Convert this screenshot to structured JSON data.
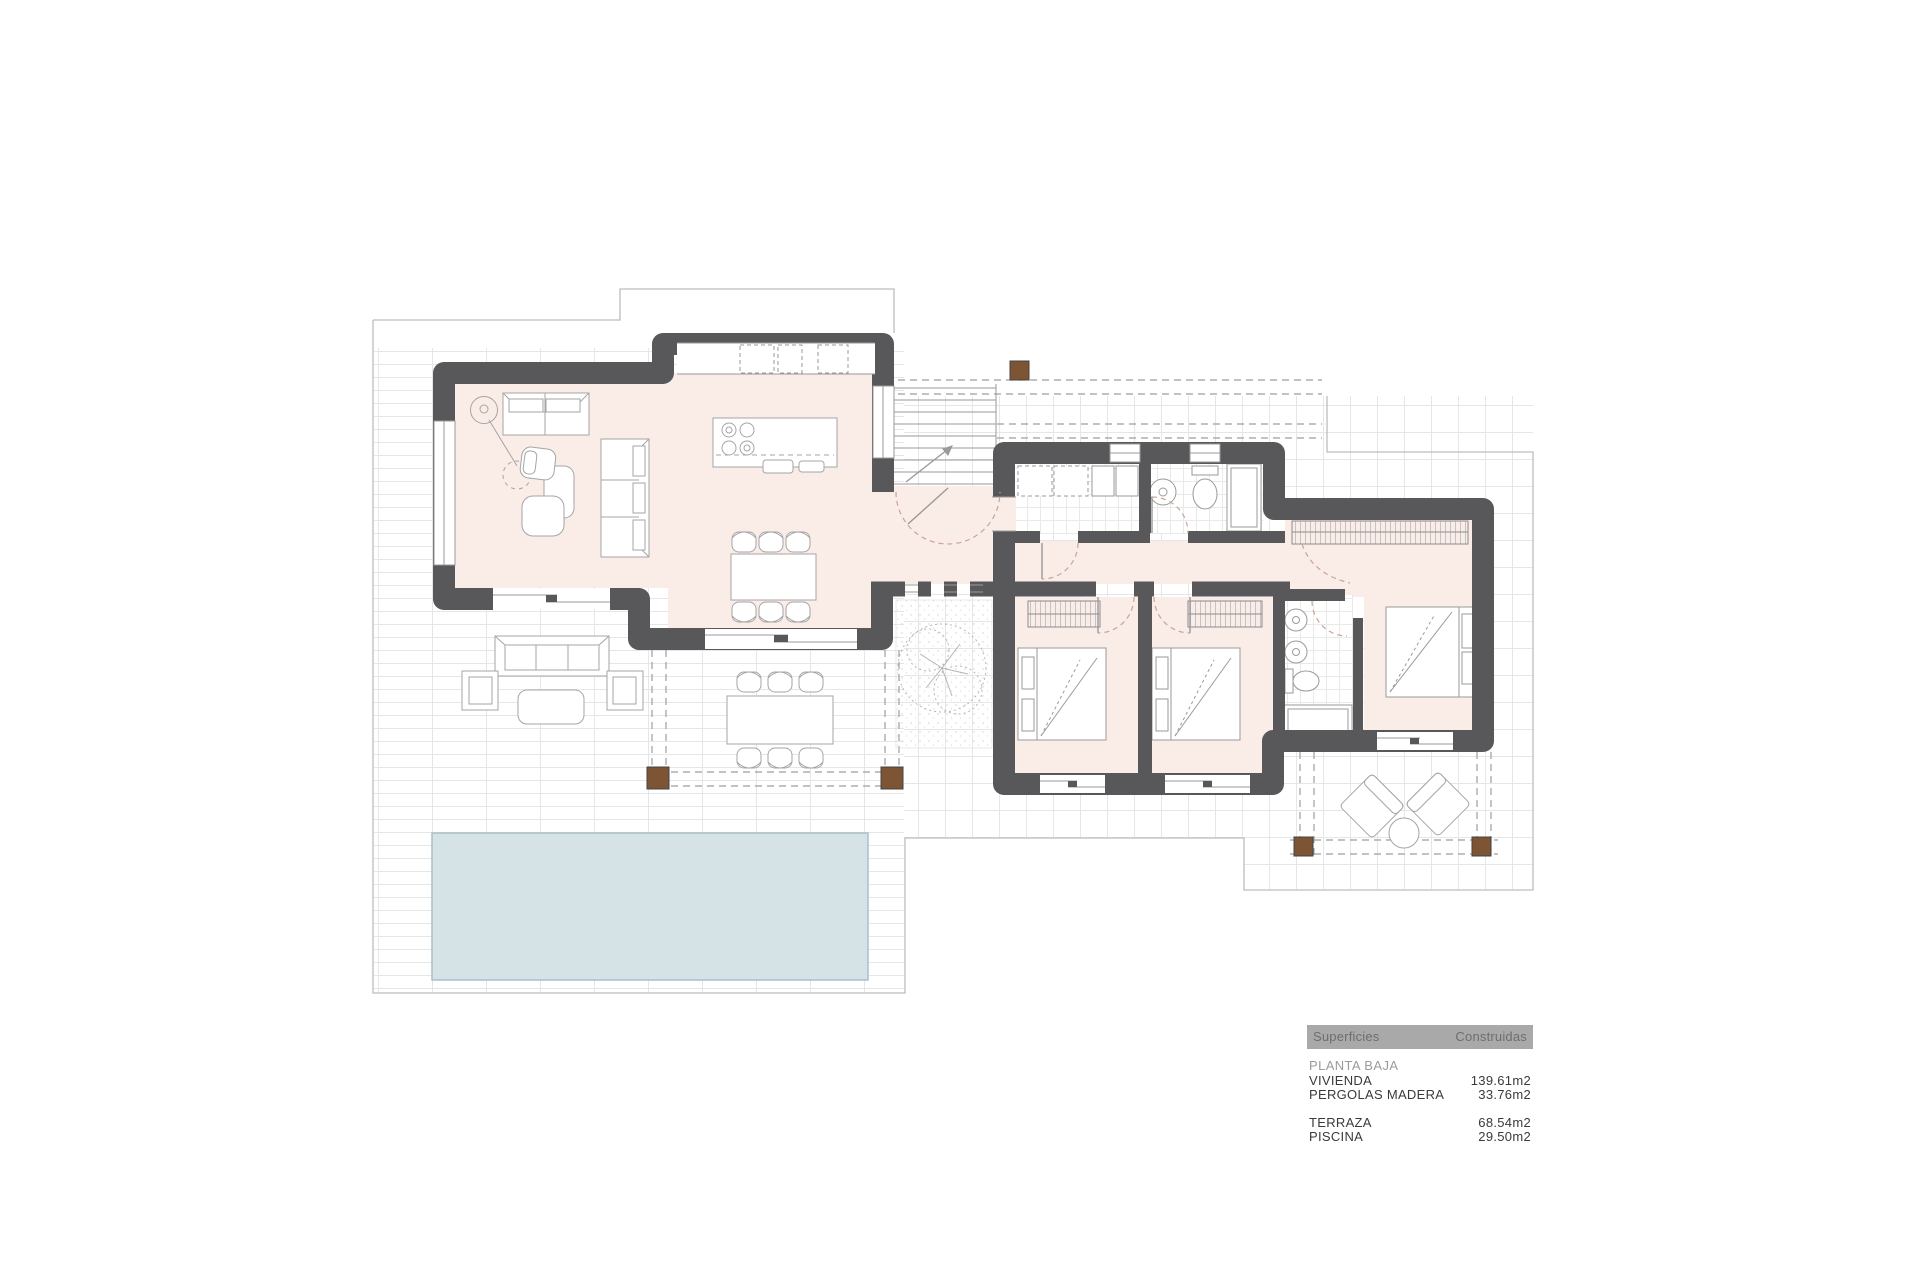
{
  "title": "Floor plan — Planta Baja",
  "table": {
    "header": {
      "left": "Superficies",
      "right": "Construidas"
    },
    "section": "PLANTA BAJA",
    "rows": [
      {
        "label": "VIVIENDA",
        "value": "139.61m2"
      },
      {
        "label": "PERGOLAS MADERA",
        "value": "33.76m2"
      },
      {
        "label": "TERRAZA",
        "value": "68.54m2"
      },
      {
        "label": "PISCINA",
        "value": "29.50m2"
      }
    ]
  },
  "plan": {
    "colors": {
      "wall": "#58585a",
      "floor": "#faece6",
      "pool": "#d5e2e6",
      "pool_border": "#a9bfc7",
      "pergola_post": "#7d5434",
      "door_arc": "#c9a49a",
      "furniture_line": "#a5a5a5",
      "site_line": "#bdbdbd"
    },
    "features": [
      "living-room",
      "kitchen-island",
      "dining-area",
      "entrance-hall",
      "utility-room",
      "bathroom-1",
      "bedroom-2",
      "bedroom-3",
      "ensuite-bathroom",
      "master-bedroom",
      "courtyard-tree",
      "terrace",
      "wood-pergola",
      "swimming-pool",
      "outdoor-lounge",
      "outdoor-dining",
      "entrance-steps"
    ]
  }
}
